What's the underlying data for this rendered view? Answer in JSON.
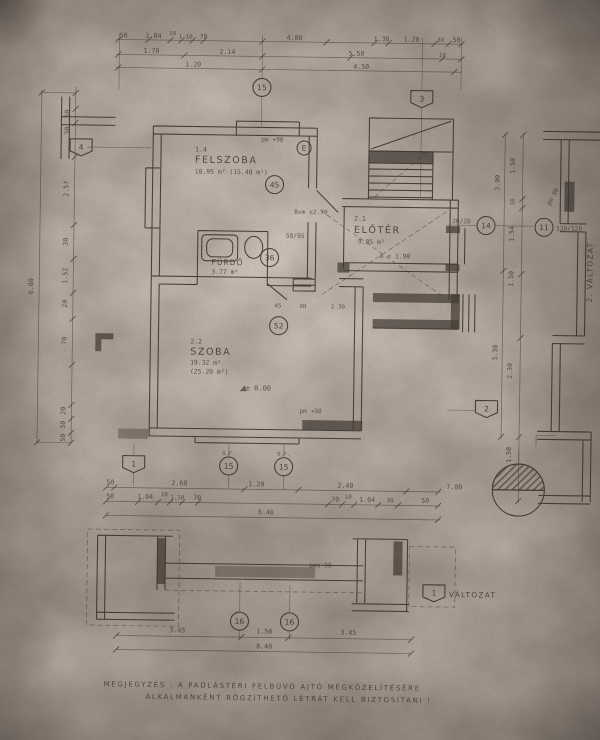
{
  "sheet": {
    "paper_color": "#c5b9b0",
    "ink_color": "#352e29",
    "note_line1": "MEGJEGYZÉS : A PADLÁSTÉRI FELBÚVÓ AJTÓ MEGKÖZELÍTÉSÉRE",
    "note_line2": "ALKALMANKÉNT RÖGZÍTHETŐ LÉTRÁT KELL BIZTOSÍTANI !",
    "variant1_label": "VÁLTOZAT",
    "variant2_label": "2. VÁLTOZAT"
  },
  "rooms": {
    "felszoba": {
      "no": "1.4",
      "name": "FELSZOBA",
      "area": "10.95 m²  (15.40 m²)"
    },
    "eloter": {
      "no": "2.1",
      "name": "ELŐTÉR",
      "area": "9.05 m²",
      "height": "m = 1.90"
    },
    "szoba": {
      "no": "2.2",
      "name": "SZOBA",
      "area": "19.32 m²",
      "area2": "(25.20 m²)"
    },
    "furdo": {
      "name": "FÜRDŐ",
      "area": "3.77 m²"
    }
  },
  "annotations": {
    "pm_felszoba": "pm +90",
    "bvm": "Bvm ±2.70",
    "door_size": "50/95",
    "level_zero": "± 0.00",
    "pm_szoba": "pm +90",
    "pms_detail": "pms 90",
    "pm_side": "pm 90",
    "col_size": "20/20",
    "win_size": "120/120",
    "bf": "B.F."
  },
  "plan": {
    "markers": [
      {
        "s": "c",
        "l": "15",
        "x": 258,
        "y": 88
      },
      {
        "s": "h",
        "l": "3",
        "x": 418,
        "y": 97
      },
      {
        "s": "h",
        "l": "4",
        "x": 78,
        "y": 150
      },
      {
        "s": "c",
        "l": "E",
        "x": 301,
        "y": 148,
        "r": 7
      },
      {
        "s": "c",
        "l": "45",
        "x": 272,
        "y": 185
      },
      {
        "s": "c",
        "l": "36",
        "x": 268,
        "y": 258
      },
      {
        "s": "c",
        "l": "14",
        "x": 484,
        "y": 223
      },
      {
        "s": "c",
        "l": "11",
        "x": 542,
        "y": 224
      },
      {
        "s": "c",
        "l": "52",
        "x": 278,
        "y": 326
      },
      {
        "s": "h",
        "l": "2",
        "x": 487,
        "y": 406
      },
      {
        "s": "h",
        "l": "1",
        "x": 135,
        "y": 466
      },
      {
        "s": "c",
        "l": "15",
        "x": 230,
        "y": 467
      },
      {
        "s": "c",
        "l": "15",
        "x": 285,
        "y": 467
      },
      {
        "s": "h",
        "l": "1",
        "x": 437,
        "y": 591
      },
      {
        "s": "c",
        "l": "16",
        "x": 243,
        "y": 622
      },
      {
        "s": "c",
        "l": "16",
        "x": 293,
        "y": 622
      }
    ],
    "dim_labels": [
      {
        "t": "50",
        "x": 119,
        "y": 40
      },
      {
        "t": "1.04",
        "x": 149,
        "y": 40
      },
      {
        "t": "10",
        "x": 168,
        "y": 37,
        "cls": "dim2"
      },
      {
        "t": "1.10",
        "x": 181,
        "y": 40,
        "cls": "dim2"
      },
      {
        "t": "70",
        "x": 199,
        "y": 40
      },
      {
        "t": "4.80",
        "x": 290,
        "y": 40
      },
      {
        "t": "1.38",
        "x": 377,
        "y": 40
      },
      {
        "t": "1.20",
        "x": 407,
        "y": 40
      },
      {
        "t": "30",
        "x": 436,
        "y": 40,
        "cls": "dim2"
      },
      {
        "t": "50",
        "x": 452,
        "y": 40
      },
      {
        "t": "1.70",
        "x": 147,
        "y": 55
      },
      {
        "t": "2.14",
        "x": 223,
        "y": 55
      },
      {
        "t": "5.50",
        "x": 352,
        "y": 55
      },
      {
        "t": "10",
        "x": 438,
        "y": 55,
        "cls": "dim2"
      },
      {
        "t": "1.20",
        "x": 189,
        "y": 68
      },
      {
        "t": "4.50",
        "x": 357,
        "y": 68
      },
      {
        "t": "50",
        "x": 112,
        "y": 487
      },
      {
        "t": "2.60",
        "x": 181,
        "y": 487
      },
      {
        "t": "1.20",
        "x": 258,
        "y": 487
      },
      {
        "t": "2.40",
        "x": 347,
        "y": 487
      },
      {
        "t": "7.00",
        "x": 456,
        "y": 487
      },
      {
        "t": "50",
        "x": 112,
        "y": 501
      },
      {
        "t": "1.04",
        "x": 147,
        "y": 501
      },
      {
        "t": "10",
        "x": 166,
        "y": 498,
        "cls": "dim2"
      },
      {
        "t": "1.10",
        "x": 179,
        "y": 501,
        "cls": "dim2"
      },
      {
        "t": "70",
        "x": 199,
        "y": 501
      },
      {
        "t": "70",
        "x": 337,
        "y": 501
      },
      {
        "t": "10",
        "x": 350,
        "y": 498,
        "cls": "dim2"
      },
      {
        "t": "1.04",
        "x": 369,
        "y": 501
      },
      {
        "t": "30",
        "x": 392,
        "y": 501,
        "cls": "dim2"
      },
      {
        "t": "50",
        "x": 427,
        "y": 501
      },
      {
        "t": "6.40",
        "x": 268,
        "y": 515
      },
      {
        "t": "45",
        "x": 277,
        "y": 308,
        "cls": "dim2"
      },
      {
        "t": "90",
        "x": 302,
        "y": 308,
        "cls": "dim2"
      },
      {
        "t": "2.30",
        "x": 337,
        "y": 308,
        "cls": "dim2"
      },
      {
        "t": "50",
        "x": 66,
        "y": 117,
        "r": -90
      },
      {
        "t": "30",
        "x": 66,
        "y": 134,
        "r": -90
      },
      {
        "t": "2.57",
        "x": 66,
        "y": 192,
        "r": -90
      },
      {
        "t": "30",
        "x": 66,
        "y": 245,
        "r": -90
      },
      {
        "t": "1.52",
        "x": 66,
        "y": 279,
        "r": -90
      },
      {
        "t": "20",
        "x": 66,
        "y": 307,
        "r": -90
      },
      {
        "t": "70",
        "x": 66,
        "y": 344,
        "r": -90
      },
      {
        "t": "20",
        "x": 66,
        "y": 414,
        "r": -90
      },
      {
        "t": "30",
        "x": 66,
        "y": 428,
        "r": -90
      },
      {
        "t": "50",
        "x": 66,
        "y": 441,
        "r": -90
      },
      {
        "t": "6.80",
        "x": 32,
        "y": 290,
        "r": -90
      },
      {
        "t": "1.50",
        "x": 512,
        "y": 163,
        "r": -90
      },
      {
        "t": "10",
        "x": 512,
        "y": 199,
        "r": -90,
        "cls": "dim2"
      },
      {
        "t": "1.54",
        "x": 512,
        "y": 231,
        "r": -90
      },
      {
        "t": "1.50",
        "x": 512,
        "y": 276,
        "r": -90
      },
      {
        "t": "2.30",
        "x": 512,
        "y": 368,
        "r": -90
      },
      {
        "t": "1.50",
        "x": 512,
        "y": 452,
        "r": -90
      },
      {
        "t": "3.00",
        "x": 497,
        "y": 180,
        "r": -90
      },
      {
        "t": "3.30",
        "x": 497,
        "y": 350,
        "r": -90
      },
      {
        "t": "3.45",
        "x": 181,
        "y": 634
      },
      {
        "t": "1.50",
        "x": 268,
        "y": 634
      },
      {
        "t": "3.45",
        "x": 352,
        "y": 634
      },
      {
        "t": "8.40",
        "x": 268,
        "y": 649
      }
    ],
    "ticks": [
      [
        114,
        42
      ],
      [
        144,
        42
      ],
      [
        166,
        42
      ],
      [
        177,
        42
      ],
      [
        188,
        42
      ],
      [
        199,
        42
      ],
      [
        258,
        42
      ],
      [
        322,
        42
      ],
      [
        370,
        42
      ],
      [
        384,
        42
      ],
      [
        430,
        42
      ],
      [
        444,
        42
      ],
      [
        457,
        42
      ],
      [
        114,
        57
      ],
      [
        180,
        57
      ],
      [
        258,
        57
      ],
      [
        346,
        57
      ],
      [
        438,
        57
      ],
      [
        457,
        57
      ],
      [
        114,
        70
      ],
      [
        258,
        70
      ],
      [
        450,
        70
      ],
      [
        108,
        490
      ],
      [
        116,
        490
      ],
      [
        246,
        490
      ],
      [
        300,
        490
      ],
      [
        408,
        490
      ],
      [
        440,
        490
      ],
      [
        108,
        504
      ],
      [
        140,
        504
      ],
      [
        160,
        504
      ],
      [
        172,
        504
      ],
      [
        184,
        504
      ],
      [
        200,
        504
      ],
      [
        330,
        504
      ],
      [
        344,
        504
      ],
      [
        356,
        504
      ],
      [
        380,
        504
      ],
      [
        400,
        504
      ],
      [
        440,
        504
      ],
      [
        108,
        518
      ],
      [
        440,
        518
      ],
      [
        120,
        638
      ],
      [
        245,
        638
      ],
      [
        292,
        638
      ],
      [
        415,
        638
      ],
      [
        120,
        652
      ],
      [
        415,
        652
      ],
      [
        72,
        96
      ],
      [
        72,
        112
      ],
      [
        72,
        126
      ],
      [
        72,
        160
      ],
      [
        72,
        228
      ],
      [
        72,
        262
      ],
      [
        72,
        296
      ],
      [
        72,
        322
      ],
      [
        72,
        368
      ],
      [
        72,
        408
      ],
      [
        72,
        422
      ],
      [
        72,
        436
      ],
      [
        72,
        446
      ],
      [
        38,
        96
      ],
      [
        38,
        446
      ],
      [
        520,
        132
      ],
      [
        520,
        196
      ],
      [
        520,
        205
      ],
      [
        520,
        271
      ],
      [
        520,
        335
      ],
      [
        520,
        434
      ],
      [
        520,
        498
      ],
      [
        502,
        132
      ],
      [
        502,
        268
      ],
      [
        502,
        434
      ]
    ]
  }
}
